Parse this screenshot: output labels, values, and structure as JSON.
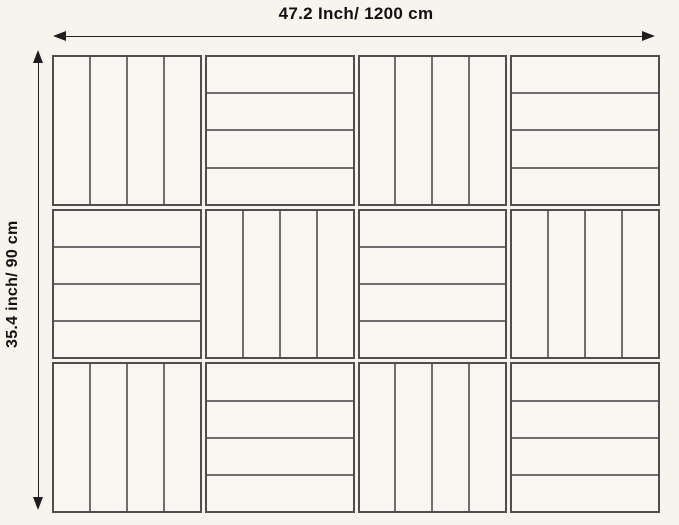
{
  "diagram": {
    "width_label": "47.2 Inch/ 1200 cm",
    "height_label": "35.4 inch/ 90 cm",
    "grid": {
      "columns": 4,
      "rows": 3,
      "slats_per_tile": 4,
      "pattern": [
        [
          "vertical",
          "horizontal",
          "vertical",
          "horizontal"
        ],
        [
          "horizontal",
          "vertical",
          "horizontal",
          "vertical"
        ],
        [
          "vertical",
          "horizontal",
          "vertical",
          "horizontal"
        ]
      ]
    },
    "colors": {
      "background": "#f7f4ee",
      "tile_fill": "#f9f6f1",
      "tile_border": "#4e4e4e",
      "slat_divider": "#6e6e6e",
      "arrow": "#1f1f1f",
      "label_text": "#111111"
    }
  }
}
